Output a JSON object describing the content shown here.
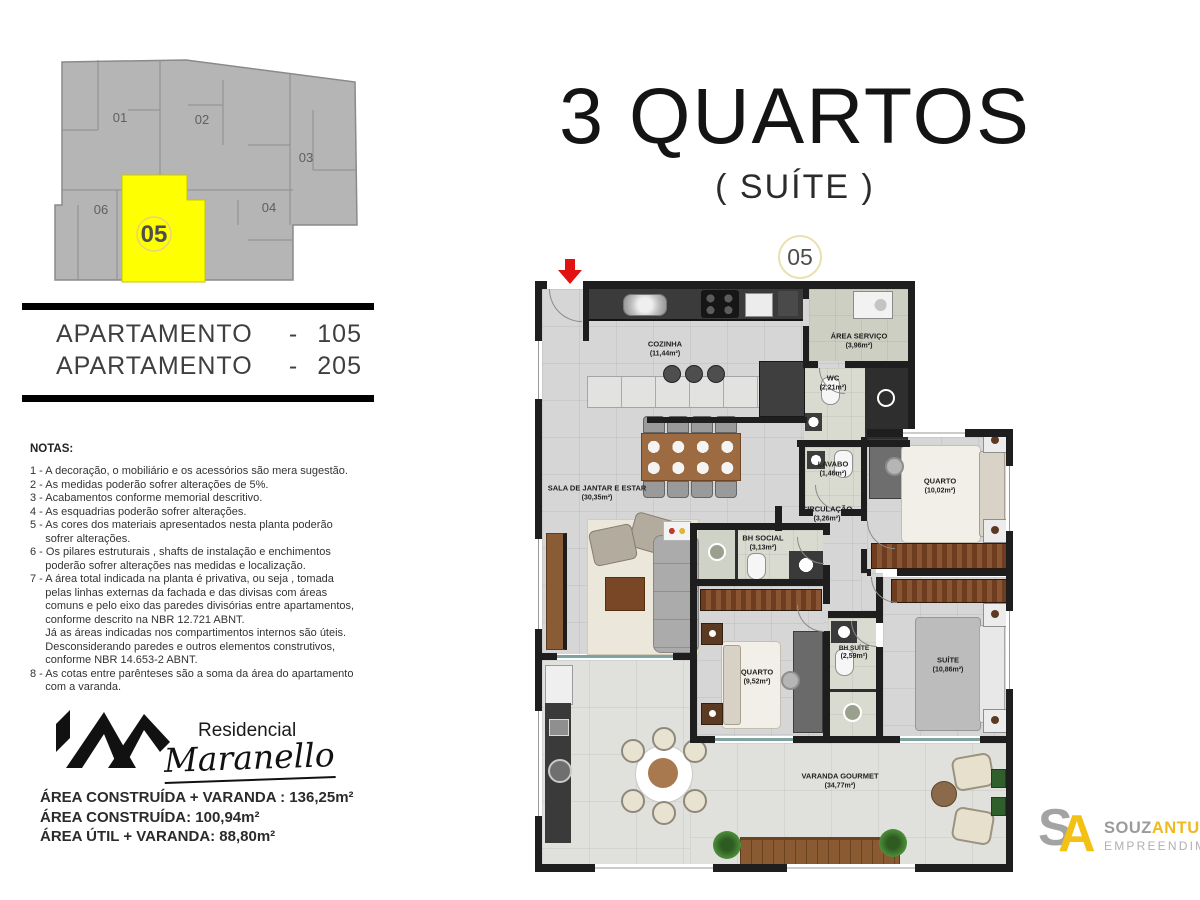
{
  "key_plan": {
    "units": [
      "01",
      "02",
      "03",
      "04",
      "05",
      "06"
    ],
    "highlighted_unit": "05",
    "highlight_color": "#feff00"
  },
  "apartments": [
    {
      "label": "APARTAMENTO",
      "dash": "-",
      "number": "105"
    },
    {
      "label": "APARTAMENTO",
      "dash": "-",
      "number": "205"
    }
  ],
  "notas": {
    "heading": "NOTAS:",
    "body": "1 - A decoração, o mobiliário e os acessórios são mera sugestão.\n2 - As medidas poderão sofrer alterações de 5%.\n3 - Acabamentos conforme memorial descritivo.\n4 - As esquadrias poderão sofrer alterações.\n5 - As cores dos materiais apresentados nesta planta poderão\n     sofrer alterações.\n6 - Os pilares estruturais , shafts de instalação e enchimentos\n     poderão sofrer alterações nas medidas e localização.\n7 - A área total indicada na planta é privativa, ou seja , tomada\n     pelas linhas externas da fachada e das divisas com áreas\n     comuns e pelo eixo das paredes divisórias entre apartamentos,\n     conforme descrito na NBR 12.721 ABNT.\n     Já as áreas indicadas nos compartimentos internos são úteis.\n     Desconsiderando paredes e outros elementos construtivos,\n     conforme NBR 14.653-2 ABNT.\n8 - As cotas entre parênteses são a soma da área do apartamento\n     com a varanda."
  },
  "brand": {
    "line1": "Residencial",
    "line2": "Maranello"
  },
  "areas": {
    "line1": "ÁREA CONSTRUÍDA + VARANDA : 136,25m²",
    "line2": "ÁREA CONSTRUÍDA: 100,94m²",
    "line3": "ÁREA ÚTIL + VARANDA: 88,80m²"
  },
  "title": {
    "main": "3 QUARTOS",
    "sub": "( SUÍTE )",
    "unit_badge": "05"
  },
  "plan": {
    "rooms": [
      {
        "name": "COZINHA",
        "area": "(11,44m²)"
      },
      {
        "name": "ÁREA SERVIÇO",
        "area": "(3,96m²)"
      },
      {
        "name": "WC",
        "area": "(2,21m²)"
      },
      {
        "name": "LAVABO",
        "area": "(1,46m²)"
      },
      {
        "name": "CIRCULAÇÃO",
        "area": "(3,26m²)"
      },
      {
        "name": "QUARTO",
        "area": "(10,02m²)"
      },
      {
        "name": "SALA DE JANTAR E ESTAR",
        "area": "(30,35m²)"
      },
      {
        "name": "BH SOCIAL",
        "area": "(3,13m²)"
      },
      {
        "name": "QUARTO",
        "area": "(9,52m²)"
      },
      {
        "name": "BH SUÍTE",
        "area": "(2,59m²)"
      },
      {
        "name": "SUÍTE",
        "area": "(10,86m²)"
      },
      {
        "name": "VARANDA GOURMET",
        "area": "(34,77m²)"
      }
    ]
  },
  "developer": {
    "monogram_s": "S",
    "monogram_a": "A",
    "name_gray": "SOUZ",
    "name_yellow": "ANTUNES",
    "subtitle": "EMPREENDIMENTOS",
    "accent_yellow": "#f2c113"
  },
  "colors": {
    "arrow_red": "#e01212",
    "wall": "#1e1e1e",
    "unit_yellow": "#feff00"
  }
}
